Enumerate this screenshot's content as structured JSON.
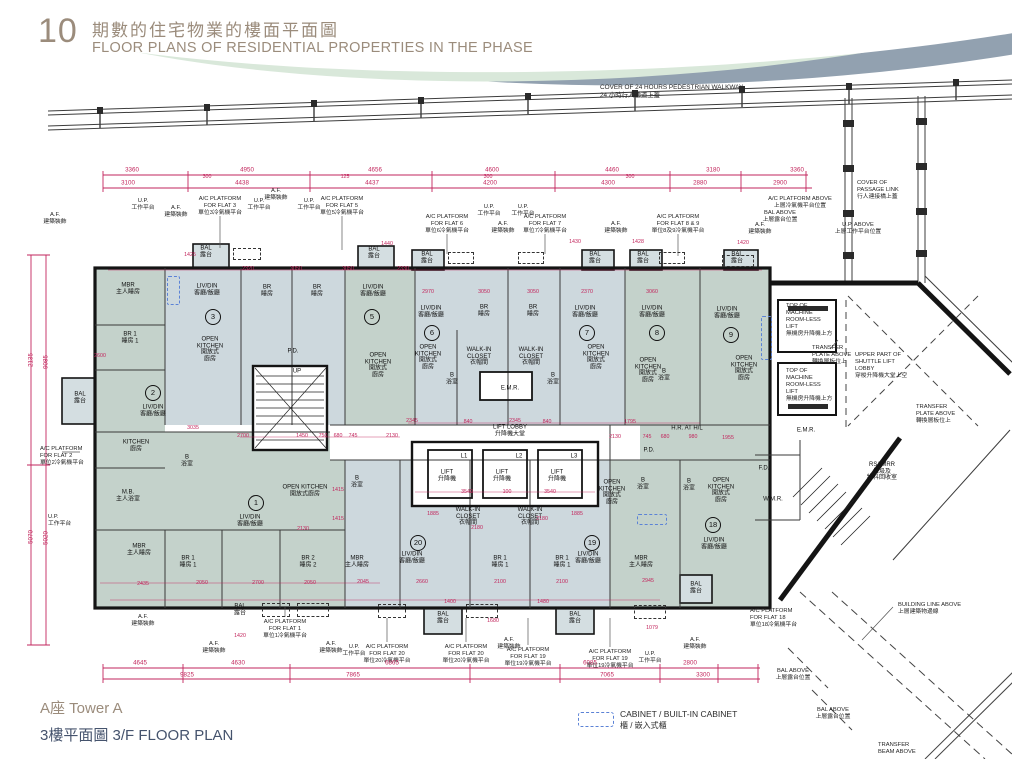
{
  "header": {
    "number": "10",
    "title_zh": "期數的住宅物業的樓面平面圖",
    "title_en": "FLOOR PLANS OF RESIDENTIAL PROPERTIES IN THE PHASE"
  },
  "footer": {
    "tower": "A座  Tower A",
    "floor": "3樓平面圖  3/F FLOOR PLAN"
  },
  "legend": {
    "cabinet_en": "CABINET / BUILT-IN CABINET",
    "cabinet_zh": "櫃 / 嵌入式櫃"
  },
  "colors": {
    "dimension_red": "#c2255c",
    "unit_blue": "#cdd8dd",
    "unit_green": "#c4d2cb",
    "wall_black": "#141414",
    "cabinet_blue": "#5b82d6",
    "title_taupe": "#9b8c7c",
    "title_navy": "#45536d"
  },
  "plan": {
    "walkway_label": "COVER OF 24 HOURS PEDESTRIAN WALKWAY\n24 小時行人通道上蓋",
    "flat_numbers": [
      {
        "n": "1",
        "x": 256,
        "y": 503
      },
      {
        "n": "2",
        "x": 153,
        "y": 393
      },
      {
        "n": "3",
        "x": 213,
        "y": 317
      },
      {
        "n": "5",
        "x": 372,
        "y": 317
      },
      {
        "n": "6",
        "x": 432,
        "y": 333
      },
      {
        "n": "7",
        "x": 587,
        "y": 333
      },
      {
        "n": "8",
        "x": 657,
        "y": 333
      },
      {
        "n": "9",
        "x": 731,
        "y": 335
      },
      {
        "n": "18",
        "x": 713,
        "y": 525
      },
      {
        "n": "19",
        "x": 592,
        "y": 543
      },
      {
        "n": "20",
        "x": 418,
        "y": 543
      }
    ],
    "rooms": [
      {
        "t": "MBR\n主人睡房",
        "x": 128,
        "y": 289
      },
      {
        "t": "BR 1\n睡房 1",
        "x": 130,
        "y": 338
      },
      {
        "t": "LIV/DIN\n客廳/飯廳",
        "x": 153,
        "y": 411
      },
      {
        "t": "KITCHEN\n廚房",
        "x": 136,
        "y": 446
      },
      {
        "t": "BAL\n露台",
        "x": 80,
        "y": 398
      },
      {
        "t": "LIV/DIN\n客廳/飯廳",
        "x": 207,
        "y": 290
      },
      {
        "t": "OPEN\nKITCHEN\n開放式\n廚房",
        "x": 210,
        "y": 350
      },
      {
        "t": "BR\n睡房",
        "x": 267,
        "y": 291
      },
      {
        "t": "BR\n睡房",
        "x": 317,
        "y": 291
      },
      {
        "t": "BAL\n露台",
        "x": 206,
        "y": 252
      },
      {
        "t": "LIV/DIN\n客廳/飯廳",
        "x": 373,
        "y": 291
      },
      {
        "t": "OPEN\nKITCHEN\n開放式\n廚房",
        "x": 378,
        "y": 366
      },
      {
        "t": "BAL\n露台",
        "x": 374,
        "y": 253
      },
      {
        "t": "LIV/DIN\n客廳/飯廳",
        "x": 431,
        "y": 312
      },
      {
        "t": "OPEN\nKITCHEN\n開放式\n廚房",
        "x": 428,
        "y": 358
      },
      {
        "t": "BR\n睡房",
        "x": 484,
        "y": 311
      },
      {
        "t": "WALK-IN\nCLOSET\n衣帽間",
        "x": 479,
        "y": 357
      },
      {
        "t": "BR\n睡房",
        "x": 533,
        "y": 311
      },
      {
        "t": "WALK-IN\nCLOSET\n衣帽間",
        "x": 531,
        "y": 357
      },
      {
        "t": "BAL\n露台",
        "x": 427,
        "y": 258
      },
      {
        "t": "LIV/DIN\n客廳/飯廳",
        "x": 585,
        "y": 312
      },
      {
        "t": "OPEN\nKITCHEN\n開放式\n廚房",
        "x": 596,
        "y": 358
      },
      {
        "t": "BAL\n露台",
        "x": 595,
        "y": 258
      },
      {
        "t": "LIV/DIN\n客廳/飯廳",
        "x": 652,
        "y": 312
      },
      {
        "t": "OPEN\nKITCHEN\n開放式\n廚房",
        "x": 648,
        "y": 371
      },
      {
        "t": "BAL\n露台",
        "x": 643,
        "y": 258
      },
      {
        "t": "LIV/DIN\n客廳/飯廳",
        "x": 727,
        "y": 313
      },
      {
        "t": "OPEN\nKITCHEN\n開放式\n廚房",
        "x": 744,
        "y": 369
      },
      {
        "t": "BAL\n露台",
        "x": 737,
        "y": 258
      },
      {
        "t": "B\n浴室",
        "x": 452,
        "y": 379
      },
      {
        "t": "B\n浴室",
        "x": 553,
        "y": 379
      },
      {
        "t": "B\n浴室",
        "x": 664,
        "y": 375
      },
      {
        "t": "LIV/DIN\n客廳/飯廳",
        "x": 250,
        "y": 521
      },
      {
        "t": "OPEN KITCHEN\n開放式廚房",
        "x": 305,
        "y": 491
      },
      {
        "t": "M.B.\n主人浴室",
        "x": 128,
        "y": 496
      },
      {
        "t": "B\n浴室",
        "x": 187,
        "y": 461
      },
      {
        "t": "MBR\n主人睡房",
        "x": 139,
        "y": 550
      },
      {
        "t": "BR 1\n睡房 1",
        "x": 188,
        "y": 562
      },
      {
        "t": "BR 2\n睡房 2",
        "x": 308,
        "y": 562
      },
      {
        "t": "BAL\n露台",
        "x": 240,
        "y": 610
      },
      {
        "t": "MBR\n主人睡房",
        "x": 357,
        "y": 562
      },
      {
        "t": "B\n浴室",
        "x": 357,
        "y": 482
      },
      {
        "t": "LIV/DIN\n客廳/飯廳",
        "x": 412,
        "y": 558
      },
      {
        "t": "WALK-IN\nCLOSET\n衣帽間",
        "x": 468,
        "y": 517
      },
      {
        "t": "BR 1\n睡房 1",
        "x": 500,
        "y": 562
      },
      {
        "t": "WALK-IN\nCLOSET\n衣帽間",
        "x": 530,
        "y": 517
      },
      {
        "t": "BR 1\n睡房 1",
        "x": 562,
        "y": 562
      },
      {
        "t": "LIV/DIN\n客廳/飯廳",
        "x": 588,
        "y": 558
      },
      {
        "t": "OPEN\nKITCHEN\n開放式\n廚房",
        "x": 612,
        "y": 493
      },
      {
        "t": "MBR\n主人睡房",
        "x": 641,
        "y": 562
      },
      {
        "t": "LIV/DIN\n客廳/飯廳",
        "x": 714,
        "y": 544
      },
      {
        "t": "OPEN\nKITCHEN\n開放式\n廚房",
        "x": 721,
        "y": 491
      },
      {
        "t": "B\n浴室",
        "x": 643,
        "y": 484
      },
      {
        "t": "B\n浴室",
        "x": 689,
        "y": 485
      },
      {
        "t": "BAL\n露台",
        "x": 443,
        "y": 618
      },
      {
        "t": "BAL\n露台",
        "x": 575,
        "y": 618
      },
      {
        "t": "BAL\n露台",
        "x": 696,
        "y": 588
      },
      {
        "t": "LIFT LOBBY\n升降機大堂",
        "x": 510,
        "y": 431
      },
      {
        "t": "L1",
        "x": 464,
        "y": 457
      },
      {
        "t": "L2",
        "x": 519,
        "y": 457
      },
      {
        "t": "L3",
        "x": 574,
        "y": 457
      },
      {
        "t": "LIFT\n升降機",
        "x": 447,
        "y": 476
      },
      {
        "t": "LIFT\n升降機",
        "x": 502,
        "y": 476
      },
      {
        "t": "LIFT\n升降機",
        "x": 557,
        "y": 476
      },
      {
        "t": "E.M.R.",
        "x": 510,
        "y": 389
      },
      {
        "t": "P.D.",
        "x": 649,
        "y": 451
      },
      {
        "t": "P.D.",
        "x": 293,
        "y": 352
      },
      {
        "t": "H.R. AT H/L",
        "x": 687,
        "y": 429
      },
      {
        "t": "UP",
        "x": 297,
        "y": 372
      },
      {
        "t": "W.M.R.",
        "x": 773,
        "y": 500
      },
      {
        "t": "E.M.R.",
        "x": 806,
        "y": 431
      },
      {
        "t": "F.D.",
        "x": 764,
        "y": 469
      },
      {
        "t": "RS&MRR\n垃圾及\n物料回收室",
        "x": 882,
        "y": 472
      }
    ],
    "annotations": [
      {
        "t": "A.F.\n建築裝飾",
        "x": 55,
        "y": 212
      },
      {
        "t": "U.P.\n工作平台",
        "x": 143,
        "y": 198
      },
      {
        "t": "A.F.\n建築裝飾",
        "x": 176,
        "y": 205
      },
      {
        "t": "A/C PLATFORM\nFOR FLAT 3\n單位3冷氣機平台",
        "x": 220,
        "y": 196
      },
      {
        "t": "U.P.\n工作平台",
        "x": 259,
        "y": 198
      },
      {
        "t": "A.F.\n建築裝飾",
        "x": 276,
        "y": 188
      },
      {
        "t": "U.P.\n工作平台",
        "x": 309,
        "y": 198
      },
      {
        "t": "A/C PLATFORM\nFOR FLAT 5\n單位5冷氣機平台",
        "x": 342,
        "y": 196
      },
      {
        "t": "U.P.\n工作平台",
        "x": 489,
        "y": 204
      },
      {
        "t": "U.P.\n工作平台",
        "x": 523,
        "y": 204
      },
      {
        "t": "A/C PLATFORM\nFOR FLAT 6\n單位6冷氣機平台",
        "x": 447,
        "y": 214
      },
      {
        "t": "A.F.\n建築裝飾",
        "x": 503,
        "y": 221
      },
      {
        "t": "A/C PLATFORM\nFOR FLAT 7\n單位7冷氣機平台",
        "x": 545,
        "y": 214
      },
      {
        "t": "A.F.\n建築裝飾",
        "x": 616,
        "y": 221
      },
      {
        "t": "A/C PLATFORM\nFOR FLAT 8 & 9\n單位8及9冷氣機平台",
        "x": 678,
        "y": 214
      },
      {
        "t": "A/C PLATFORM ABOVE\n上層冷氣機平台位置",
        "x": 800,
        "y": 196
      },
      {
        "t": "BAL ABOVE\n上層露台位置",
        "x": 780,
        "y": 210
      },
      {
        "t": "A.F.\n建築裝飾",
        "x": 760,
        "y": 222
      },
      {
        "t": "U.P. ABOVE\n上層工作平台位置",
        "x": 858,
        "y": 222
      },
      {
        "t": "COVER OF\nPASSAGE LINK\n行人連接橋上蓋",
        "x": 857,
        "y": 180,
        "a": "l"
      },
      {
        "t": "A/C PLATFORM\nFOR FLAT 2\n單位2冷氣機平台",
        "x": 40,
        "y": 446,
        "a": "l"
      },
      {
        "t": "U.P.\n工作平台",
        "x": 48,
        "y": 514,
        "a": "l"
      },
      {
        "t": "A.F.\n建築裝飾",
        "x": 143,
        "y": 614
      },
      {
        "t": "A/C PLATFORM\nFOR FLAT 1\n單位1冷氣機平台",
        "x": 285,
        "y": 619
      },
      {
        "t": "A.F.\n建築裝飾",
        "x": 214,
        "y": 641
      },
      {
        "t": "A.F.\n建築裝飾",
        "x": 331,
        "y": 641
      },
      {
        "t": "U.P.\n工作平台",
        "x": 354,
        "y": 644
      },
      {
        "t": "A/C PLATFORM\nFOR FLAT 20\n單位20冷氣機平台",
        "x": 387,
        "y": 644
      },
      {
        "t": "A/C PLATFORM\nFOR FLAT 20\n單位20冷氣機平台",
        "x": 466,
        "y": 644
      },
      {
        "t": "A.F.\n建築裝飾",
        "x": 509,
        "y": 637
      },
      {
        "t": "A/C PLATFORM\nFOR FLAT 19\n單位19冷氣機平台",
        "x": 528,
        "y": 647
      },
      {
        "t": "A/C PLATFORM\nFOR FLAT 19\n單位19冷氣機平台",
        "x": 610,
        "y": 649
      },
      {
        "t": "U.P.\n工作平台",
        "x": 650,
        "y": 651
      },
      {
        "t": "A.F.\n建築裝飾",
        "x": 695,
        "y": 637
      },
      {
        "t": "A/C PLATFORM\nFOR FLAT 18\n單位18冷氣機平台",
        "x": 750,
        "y": 608,
        "a": "l"
      },
      {
        "t": "TOP OF\nMACHINE\nROOM-LESS\nLIFT\n無機房升降機上方",
        "x": 786,
        "y": 303,
        "a": "l"
      },
      {
        "t": "TOP OF\nMACHINE\nROOM-LESS\nLIFT\n無機房升降機上方",
        "x": 786,
        "y": 368,
        "a": "l"
      },
      {
        "t": "TRANSFER\nPLATE ABOVE\n轉換層板位上",
        "x": 812,
        "y": 345,
        "a": "l"
      },
      {
        "t": "TRANSFER\nPLATE ABOVE\n轉換層板位上",
        "x": 916,
        "y": 404,
        "a": "l"
      },
      {
        "t": "UPPER PART OF\nSHUTTLE LIFT\nLOBBY\n穿梭升降機大堂上空",
        "x": 855,
        "y": 352,
        "a": "l"
      },
      {
        "t": "BUILDING LINE ABOVE\n上層建築物邊線",
        "x": 898,
        "y": 602,
        "a": "l"
      },
      {
        "t": "BAL ABOVE\n上層露台位置",
        "x": 793,
        "y": 668
      },
      {
        "t": "BAL ABOVE\n上層露台位置",
        "x": 833,
        "y": 707
      },
      {
        "t": "TRANSFER\nBEAM ABOVE",
        "x": 878,
        "y": 742,
        "a": "l"
      }
    ],
    "dims_h": [
      {
        "v": "3360",
        "x": 132,
        "y": 170
      },
      {
        "v": "4950",
        "x": 247,
        "y": 170
      },
      {
        "v": "4656",
        "x": 375,
        "y": 170
      },
      {
        "v": "4600",
        "x": 492,
        "y": 170
      },
      {
        "v": "4460",
        "x": 612,
        "y": 170
      },
      {
        "v": "3180",
        "x": 713,
        "y": 170
      },
      {
        "v": "3360",
        "x": 797,
        "y": 170
      },
      {
        "v": "3100",
        "x": 128,
        "y": 183
      },
      {
        "v": "4438",
        "x": 242,
        "y": 183
      },
      {
        "v": "4437",
        "x": 372,
        "y": 183
      },
      {
        "v": "4200",
        "x": 490,
        "y": 183
      },
      {
        "v": "4300",
        "x": 608,
        "y": 183
      },
      {
        "v": "2880",
        "x": 700,
        "y": 183
      },
      {
        "v": "2900",
        "x": 780,
        "y": 183
      },
      {
        "v": "4645",
        "x": 140,
        "y": 663
      },
      {
        "v": "4630",
        "x": 238,
        "y": 663
      },
      {
        "v": "6865",
        "x": 392,
        "y": 663
      },
      {
        "v": "6085",
        "x": 590,
        "y": 663
      },
      {
        "v": "2800",
        "x": 690,
        "y": 663
      },
      {
        "v": "9825",
        "x": 187,
        "y": 675
      },
      {
        "v": "7865",
        "x": 353,
        "y": 675
      },
      {
        "v": "7065",
        "x": 607,
        "y": 675
      },
      {
        "v": "3300",
        "x": 703,
        "y": 675
      }
    ],
    "dims_v": [
      {
        "v": "2135",
        "x": 31,
        "y": 360
      },
      {
        "v": "9085",
        "x": 46,
        "y": 362
      },
      {
        "v": "5070",
        "x": 31,
        "y": 537
      },
      {
        "v": "5020",
        "x": 46,
        "y": 538
      }
    ],
    "dims_small": [
      {
        "v": "1425",
        "x": 190,
        "y": 255
      },
      {
        "v": "2320",
        "x": 248,
        "y": 269
      },
      {
        "v": "3050",
        "x": 296,
        "y": 269
      },
      {
        "v": "3050",
        "x": 348,
        "y": 269
      },
      {
        "v": "2330",
        "x": 403,
        "y": 269
      },
      {
        "v": "1440",
        "x": 387,
        "y": 244
      },
      {
        "v": "2970",
        "x": 428,
        "y": 292
      },
      {
        "v": "3050",
        "x": 484,
        "y": 292
      },
      {
        "v": "3050",
        "x": 533,
        "y": 292
      },
      {
        "v": "2370",
        "x": 587,
        "y": 292
      },
      {
        "v": "3060",
        "x": 652,
        "y": 292
      },
      {
        "v": "2600",
        "x": 100,
        "y": 356
      },
      {
        "v": "3035",
        "x": 193,
        "y": 428
      },
      {
        "v": "2345",
        "x": 412,
        "y": 421
      },
      {
        "v": "840",
        "x": 468,
        "y": 422
      },
      {
        "v": "2345",
        "x": 515,
        "y": 421
      },
      {
        "v": "840",
        "x": 547,
        "y": 422
      },
      {
        "v": "1795",
        "x": 630,
        "y": 422
      },
      {
        "v": "2130",
        "x": 615,
        "y": 437
      },
      {
        "v": "745",
        "x": 647,
        "y": 437
      },
      {
        "v": "680",
        "x": 665,
        "y": 437
      },
      {
        "v": "980",
        "x": 693,
        "y": 437
      },
      {
        "v": "2700",
        "x": 243,
        "y": 436
      },
      {
        "v": "1450",
        "x": 302,
        "y": 436
      },
      {
        "v": "750",
        "x": 323,
        "y": 436
      },
      {
        "v": "680",
        "x": 338,
        "y": 436
      },
      {
        "v": "745",
        "x": 353,
        "y": 436
      },
      {
        "v": "2130",
        "x": 392,
        "y": 436
      },
      {
        "v": "3540",
        "x": 467,
        "y": 492
      },
      {
        "v": "100",
        "x": 507,
        "y": 492
      },
      {
        "v": "3540",
        "x": 550,
        "y": 492
      },
      {
        "v": "1885",
        "x": 433,
        "y": 514
      },
      {
        "v": "2180",
        "x": 477,
        "y": 528
      },
      {
        "v": "2180",
        "x": 542,
        "y": 519
      },
      {
        "v": "1885",
        "x": 577,
        "y": 514
      },
      {
        "v": "2660",
        "x": 422,
        "y": 582
      },
      {
        "v": "2100",
        "x": 500,
        "y": 582
      },
      {
        "v": "2100",
        "x": 562,
        "y": 582
      },
      {
        "v": "2945",
        "x": 648,
        "y": 581
      },
      {
        "v": "2435",
        "x": 143,
        "y": 584
      },
      {
        "v": "2050",
        "x": 202,
        "y": 583
      },
      {
        "v": "2700",
        "x": 258,
        "y": 583
      },
      {
        "v": "2050",
        "x": 310,
        "y": 583
      },
      {
        "v": "2045",
        "x": 363,
        "y": 582
      },
      {
        "v": "2130",
        "x": 303,
        "y": 529
      },
      {
        "v": "1415",
        "x": 338,
        "y": 519
      },
      {
        "v": "1415",
        "x": 338,
        "y": 490
      },
      {
        "v": "1400",
        "x": 450,
        "y": 602
      },
      {
        "v": "1480",
        "x": 543,
        "y": 602
      },
      {
        "v": "1680",
        "x": 493,
        "y": 621
      },
      {
        "v": "1079",
        "x": 652,
        "y": 628
      },
      {
        "v": "1420",
        "x": 743,
        "y": 243
      },
      {
        "v": "1430",
        "x": 575,
        "y": 242
      },
      {
        "v": "1428",
        "x": 638,
        "y": 242
      },
      {
        "v": "1955",
        "x": 728,
        "y": 438
      },
      {
        "v": "1420",
        "x": 240,
        "y": 636
      },
      {
        "v": "300",
        "x": 207,
        "y": 177
      },
      {
        "v": "125",
        "x": 345,
        "y": 177
      },
      {
        "v": "300",
        "x": 488,
        "y": 177
      },
      {
        "v": "300",
        "x": 630,
        "y": 177
      }
    ],
    "cabinets": [
      {
        "x": 167,
        "y": 276,
        "w": 11,
        "h": 27
      },
      {
        "x": 761,
        "y": 316,
        "w": 9,
        "h": 42
      },
      {
        "x": 637,
        "y": 514,
        "w": 28,
        "h": 9
      }
    ],
    "ac_dashed": [
      {
        "x": 233,
        "y": 248,
        "w": 26,
        "h": 10
      },
      {
        "x": 448,
        "y": 252,
        "w": 24,
        "h": 10
      },
      {
        "x": 518,
        "y": 252,
        "w": 24,
        "h": 10
      },
      {
        "x": 659,
        "y": 252,
        "w": 24,
        "h": 10
      },
      {
        "x": 722,
        "y": 255,
        "w": 30,
        "h": 10
      },
      {
        "x": 262,
        "y": 603,
        "w": 26,
        "h": 12
      },
      {
        "x": 297,
        "y": 603,
        "w": 30,
        "h": 12
      },
      {
        "x": 378,
        "y": 604,
        "w": 26,
        "h": 12
      },
      {
        "x": 466,
        "y": 604,
        "w": 30,
        "h": 12
      },
      {
        "x": 634,
        "y": 605,
        "w": 30,
        "h": 12
      }
    ]
  }
}
